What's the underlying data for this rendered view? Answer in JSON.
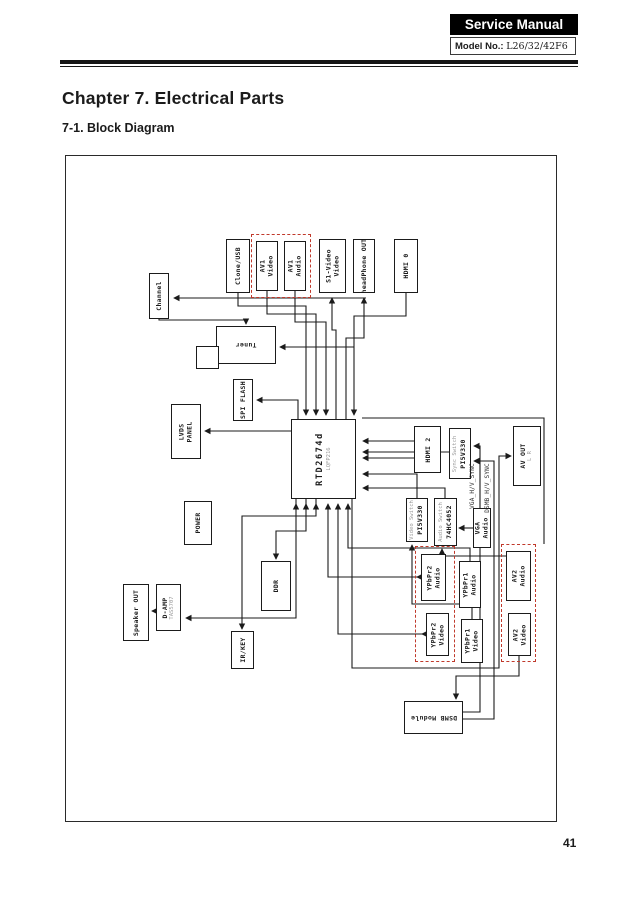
{
  "header": {
    "service_manual": "Service Manual",
    "model_label": "Model No.:",
    "model_value": "L26/32/42F6"
  },
  "chapter_title": "Chapter 7. Electrical Parts",
  "section_title": "7-1. Block Diagram",
  "page_number": "41",
  "diagram": {
    "colors": {
      "line": "#1b1b1b",
      "dashed_group": "#c0392b",
      "sub_text": "#9a9a9a"
    },
    "blocks": [
      {
        "name": "clone-usb",
        "x": 160,
        "y": 83,
        "w": 24,
        "h": 54,
        "lines": [
          "Clone/USB"
        ]
      },
      {
        "name": "av1-video",
        "x": 190,
        "y": 85,
        "w": 22,
        "h": 50,
        "lines": [
          "AV1",
          "Video"
        ]
      },
      {
        "name": "av1-audio",
        "x": 218,
        "y": 85,
        "w": 22,
        "h": 50,
        "lines": [
          "AV1",
          "Audio"
        ]
      },
      {
        "name": "s1-video",
        "x": 253,
        "y": 83,
        "w": 27,
        "h": 54,
        "lines": [
          "S1-Video",
          "Video"
        ]
      },
      {
        "name": "headphone-out",
        "x": 287,
        "y": 83,
        "w": 22,
        "h": 54,
        "lines": [
          "headPhone OUT"
        ]
      },
      {
        "name": "hdmi0",
        "x": 328,
        "y": 83,
        "w": 24,
        "h": 54,
        "lines": [
          "HDMI 0"
        ]
      },
      {
        "name": "channel",
        "x": 83,
        "y": 117,
        "w": 20,
        "h": 46,
        "lines": [
          "Channel"
        ]
      },
      {
        "name": "tuner",
        "x": 150,
        "y": 170,
        "w": 60,
        "h": 38,
        "lines": [
          "Tuner"
        ],
        "rot": "180"
      },
      {
        "name": "tuner-tab",
        "x": 130,
        "y": 190,
        "w": 23,
        "h": 23,
        "lines": []
      },
      {
        "name": "spi-flash",
        "x": 167,
        "y": 223,
        "w": 20,
        "h": 42,
        "lines": [
          "SPI FLASH"
        ]
      },
      {
        "name": "lvds-panel",
        "x": 105,
        "y": 248,
        "w": 30,
        "h": 55,
        "lines": [
          "LVDS",
          "PANEL"
        ]
      },
      {
        "name": "power",
        "x": 118,
        "y": 345,
        "w": 28,
        "h": 44,
        "lines": [
          "POWER"
        ]
      },
      {
        "name": "main-chip",
        "x": 225,
        "y": 263,
        "w": 65,
        "h": 80,
        "lines": [
          "RTD2674d"
        ],
        "sub": "LQFP216",
        "chip": true
      },
      {
        "name": "ddr",
        "x": 195,
        "y": 405,
        "w": 30,
        "h": 50,
        "lines": [
          "DDR"
        ]
      },
      {
        "name": "ir-key",
        "x": 165,
        "y": 475,
        "w": 23,
        "h": 38,
        "lines": [
          "IR/KEY"
        ]
      },
      {
        "name": "speaker-out",
        "x": 57,
        "y": 428,
        "w": 26,
        "h": 57,
        "lines": [
          "Speaker OUT"
        ]
      },
      {
        "name": "d-amp",
        "x": 90,
        "y": 428,
        "w": 25,
        "h": 47,
        "lines": [
          "D-AMP"
        ],
        "sub": "TAS5707"
      },
      {
        "name": "hdmi2",
        "x": 348,
        "y": 270,
        "w": 27,
        "h": 47,
        "lines": [
          "HDMI 2"
        ]
      },
      {
        "name": "sync-switch",
        "x": 383,
        "y": 272,
        "w": 22,
        "h": 51,
        "lines": [
          "PI5V330"
        ],
        "sub": "Sync Switch",
        "subFirst": true
      },
      {
        "name": "av-out",
        "x": 447,
        "y": 270,
        "w": 28,
        "h": 60,
        "lines": [
          "AV OUT"
        ],
        "sub": "L R"
      },
      {
        "name": "video-switch",
        "x": 340,
        "y": 342,
        "w": 22,
        "h": 44,
        "lines": [
          "PI5V330"
        ],
        "sub": "Video Switch",
        "subFirst": true
      },
      {
        "name": "audio-switch",
        "x": 368,
        "y": 342,
        "w": 23,
        "h": 48,
        "lines": [
          "74HC4052"
        ],
        "sub": "Audio Switch",
        "subFirst": true
      },
      {
        "name": "vga-audio",
        "x": 407,
        "y": 352,
        "w": 18,
        "h": 40,
        "lines": [
          "VGA",
          "Audio"
        ]
      },
      {
        "name": "ypbpr2-audio",
        "x": 355,
        "y": 398,
        "w": 25,
        "h": 47,
        "lines": [
          "YPbPr2",
          "Audio"
        ]
      },
      {
        "name": "ypbpr1-audio",
        "x": 393,
        "y": 405,
        "w": 22,
        "h": 47,
        "lines": [
          "YPbPr1",
          "Audio"
        ]
      },
      {
        "name": "av2-audio",
        "x": 440,
        "y": 395,
        "w": 25,
        "h": 50,
        "lines": [
          "AV2",
          "Audio"
        ]
      },
      {
        "name": "ypbpr2-video",
        "x": 360,
        "y": 457,
        "w": 23,
        "h": 43,
        "lines": [
          "YPbPr2",
          "Video"
        ]
      },
      {
        "name": "ypbpr1-video",
        "x": 395,
        "y": 463,
        "w": 22,
        "h": 44,
        "lines": [
          "YPbPr1",
          "Video"
        ]
      },
      {
        "name": "av2-video",
        "x": 442,
        "y": 457,
        "w": 23,
        "h": 43,
        "lines": [
          "AV2",
          "Video"
        ]
      },
      {
        "name": "dsmb-module",
        "x": 338,
        "y": 545,
        "w": 59,
        "h": 33,
        "lines": [
          "DSMB Module"
        ],
        "rot": "180"
      }
    ],
    "groups": [
      {
        "name": "av1-group",
        "x": 185,
        "y": 78,
        "w": 60,
        "h": 64
      },
      {
        "name": "ypbpr2-group",
        "x": 349,
        "y": 390,
        "w": 40,
        "h": 116
      },
      {
        "name": "av2-group",
        "x": 435,
        "y": 388,
        "w": 35,
        "h": 118
      }
    ],
    "float_labels": [
      {
        "name": "label-vga-sync",
        "text": "VGA_H/V_SYNC",
        "x": 400,
        "y": 280,
        "h": 100
      },
      {
        "name": "label-dsmb-sync",
        "text": "DSMB_H/V_SYNC",
        "x": 415,
        "y": 278,
        "h": 108
      }
    ]
  }
}
